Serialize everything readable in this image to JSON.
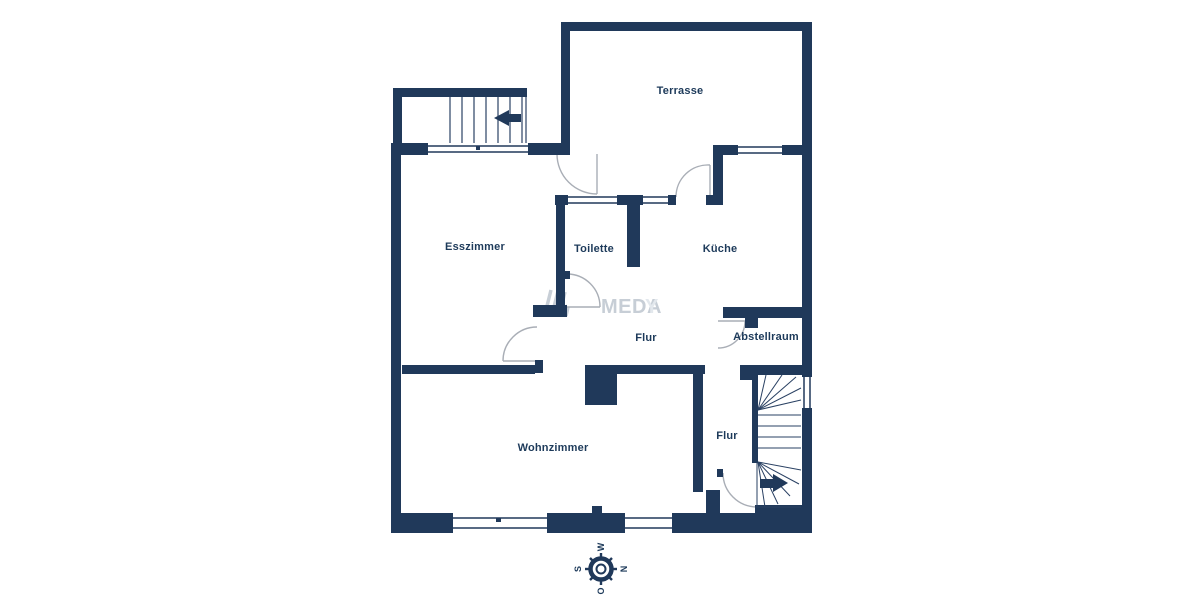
{
  "plan": {
    "rooms": {
      "terrasse": "Terrasse",
      "esszimmer": "Esszimmer",
      "toilette": "Toilette",
      "kueche": "Küche",
      "flur_mitte": "Flur",
      "abstellraum": "Abstellraum",
      "wohnzimmer": "Wohnzimmer",
      "flur_unten": "Flur"
    }
  },
  "compass": {
    "west": "W",
    "south": "S",
    "north": "N",
    "east": "O"
  },
  "watermark": {
    "text_main": "MEDA",
    "text_faint": "Y"
  },
  "colors": {
    "wall": "#20395a",
    "label": "#1d3a5a",
    "arc": "#a9aeb6",
    "stair": "#2a4163",
    "wm": "#c7ced6",
    "wm_faint": "#e3e8ed"
  }
}
